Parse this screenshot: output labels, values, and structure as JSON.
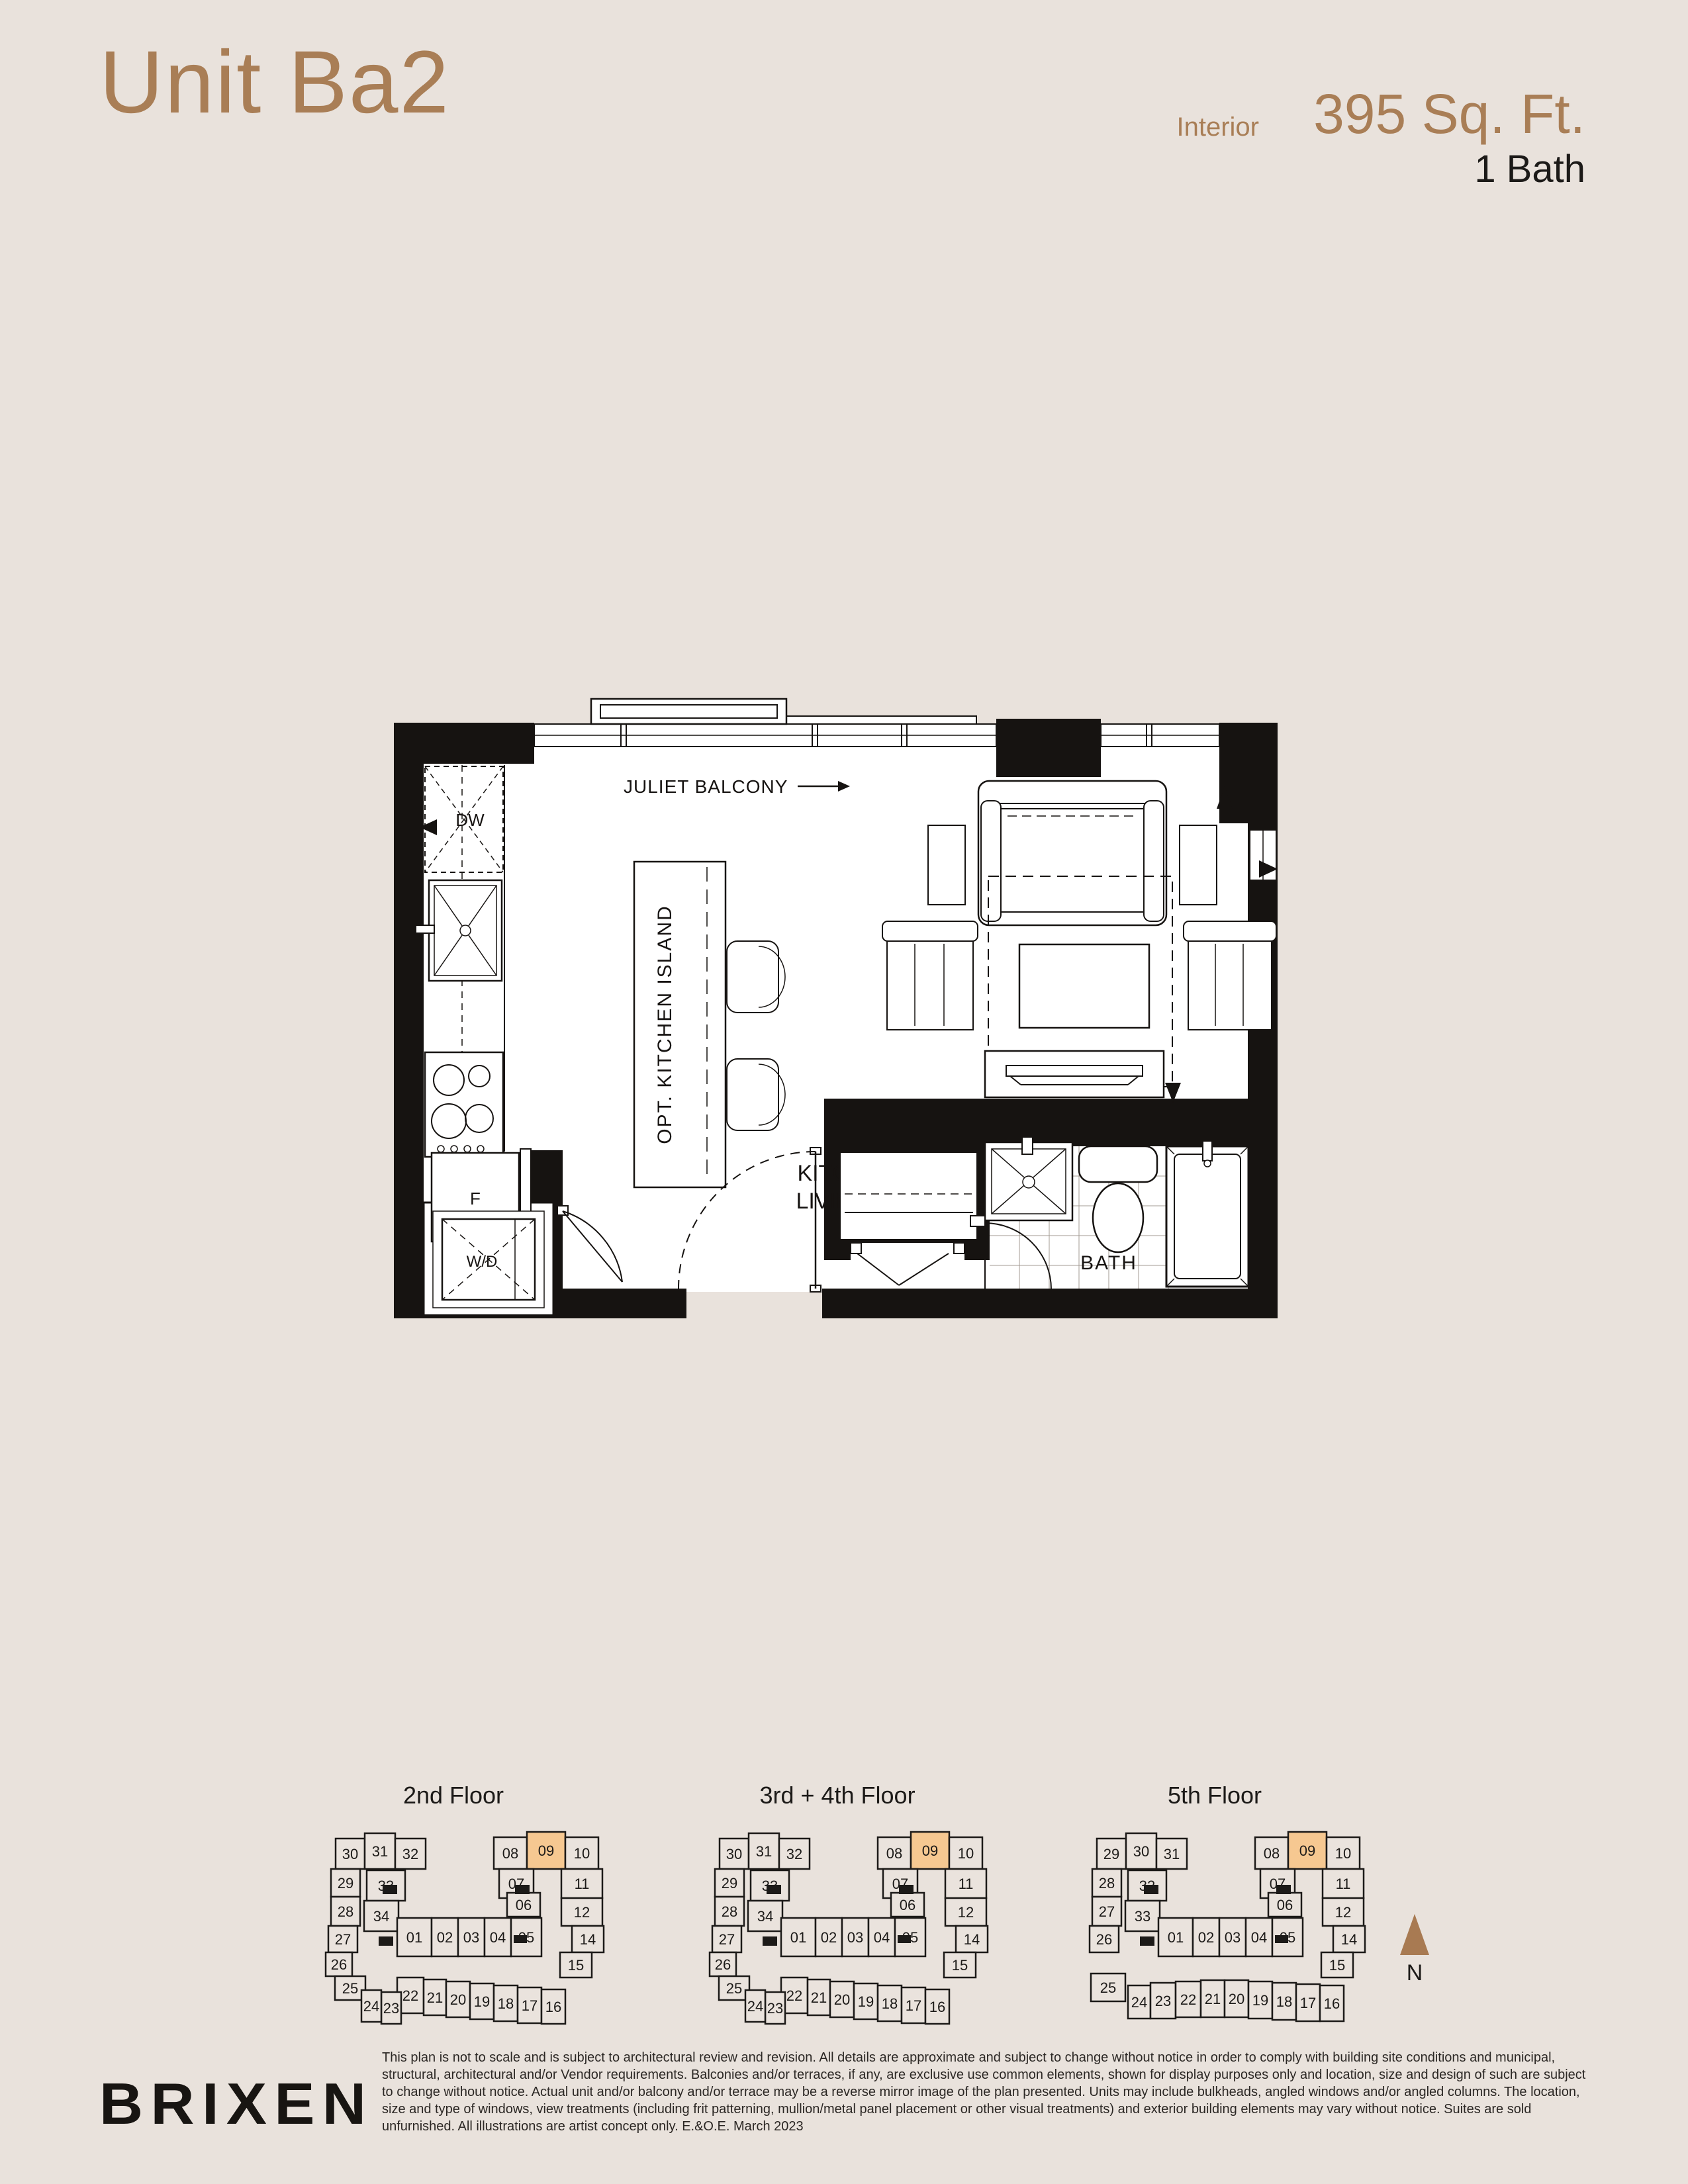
{
  "header": {
    "unit_title": "Unit Ba2",
    "interior_label": "Interior",
    "area": "395 Sq. Ft.",
    "bath": "1 Bath"
  },
  "floorplan": {
    "balcony_label": "JULIET BALCONY",
    "island_label": "OPT. KITCHEN ISLAND",
    "room_label_line1": "KITCHEN/DINING/",
    "room_label_line2": "LIVING/SLEEPING",
    "room_dims": "22'8\" x 9'0\"",
    "labels": {
      "dw": "DW",
      "fridge": "F",
      "washer_dryer": "W/D",
      "bath": "BATH"
    }
  },
  "floor_keys": [
    {
      "title": "2nd Floor",
      "layout": "A",
      "highlight": "09",
      "units": [
        "30",
        "31",
        "32",
        "29",
        "33",
        "28",
        "34",
        "27",
        "26",
        "25",
        "08",
        "09",
        "10",
        "07",
        "11",
        "06",
        "12",
        "14",
        "15",
        "01",
        "02",
        "03",
        "04",
        "05",
        "22",
        "21",
        "20",
        "19",
        "18",
        "17",
        "16",
        "23",
        "24"
      ]
    },
    {
      "title": "3rd + 4th Floor",
      "layout": "A",
      "highlight": "09",
      "units": [
        "30",
        "31",
        "32",
        "29",
        "33",
        "28",
        "34",
        "27",
        "26",
        "25",
        "08",
        "09",
        "10",
        "07",
        "11",
        "06",
        "12",
        "14",
        "15",
        "01",
        "02",
        "03",
        "04",
        "05",
        "22",
        "21",
        "20",
        "19",
        "18",
        "17",
        "16",
        "23",
        "24"
      ]
    },
    {
      "title": "5th Floor",
      "layout": "B",
      "highlight": "09",
      "units": [
        "29",
        "30",
        "31",
        "28",
        "32",
        "27",
        "33",
        "26",
        "25",
        "08",
        "09",
        "10",
        "07",
        "11",
        "06",
        "12",
        "14",
        "15",
        "01",
        "02",
        "03",
        "04",
        "05",
        "24",
        "23",
        "22",
        "21",
        "20",
        "19",
        "18",
        "17",
        "16"
      ]
    }
  ],
  "compass": {
    "label": "N"
  },
  "footer": {
    "logo": "BRIXEN",
    "disclaimer": "This plan is not to scale and is subject to architectural review and revision. All details are approximate and subject to change without notice in order to comply with building site conditions and municipal, structural, architectural and/or Vendor requirements. Balconies and/or terraces, if any, are exclusive use common elements, shown for display purposes only and location, size and design of such are subject to change without notice. Actual unit and/or balcony and/or terrace may be a reverse mirror image of the plan presented. Units may include bulkheads, angled windows and/or angled columns. The location, size and type of windows, view treatments (including frit patterning, mullion/metal panel placement or other visual treatments) and exterior building elements may vary without notice. Suites are sold unfurnished. All illustrations are artist concept only. E.&O.E. March 2023"
  },
  "colors": {
    "background": "#e9e2dc",
    "accent_brown": "#a97e56",
    "highlight": "#f6c891",
    "ink": "#1c1a18"
  }
}
